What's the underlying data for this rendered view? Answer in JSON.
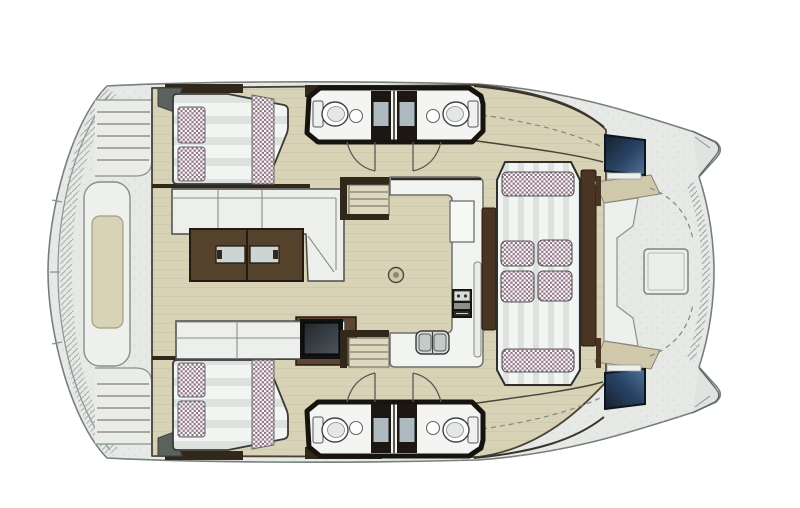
{
  "meta": {
    "description": "Top-down floor plan of a sailing catamaran interior",
    "background": "#ffffff"
  },
  "colors": {
    "hull": "#e6e9e6",
    "hull_light": "#eceeec",
    "speckle": "#c9cec9",
    "deck_beige": "#d8d2b6",
    "deck_plank_line": "#cdc6a9",
    "bench_beige": "#cfc8ab",
    "steps_beige": "#ded8c0",
    "wood": "#4a3423",
    "wood_dark": "#32271b",
    "wood_mid": "#5d4733",
    "sofa_white": "#edefec",
    "mattress_white": "#f3f5f2",
    "mattress_stripe": "#dde2de",
    "checker_dark": "#8f7284",
    "checker_light": "#ffffff",
    "bath_floor": "#f4f5f3",
    "wall_dark": "#17130e",
    "shower_dark": "#1c1712",
    "shower_tray": "#aeb9c0",
    "counter_white": "#f2f4f1",
    "cockpit_white": "#eef0ed",
    "sink_steel": "#d6dcda",
    "basin": "#c3cbc9",
    "table_wood": "#55422d",
    "table_inset": "#ccd5d3",
    "screen_dark": "#15202e",
    "screen_blue": "#517499",
    "window_mid": "#2a4465",
    "hatch_circle": "#cfc8a9",
    "stove_panel": "#15130f",
    "wardrobe_grey": "#5b615d",
    "fixture_white": "#fdfdfd"
  },
  "legend": [
    "port-aft-cabin-double-berth",
    "starboard-aft-cabin-double-berth",
    "port-head-with-shower",
    "starboard-head-with-shower",
    "saloon-l-sofa",
    "saloon-coffee-table",
    "saloon-bench-with-tv",
    "galley-counter-with-sink-and-stove",
    "companionway-steps",
    "forward-lounge-double-berth",
    "forward-cockpit-table-and-benches",
    "bow-hatches",
    "aft-sunpad",
    "transom-steps"
  ]
}
